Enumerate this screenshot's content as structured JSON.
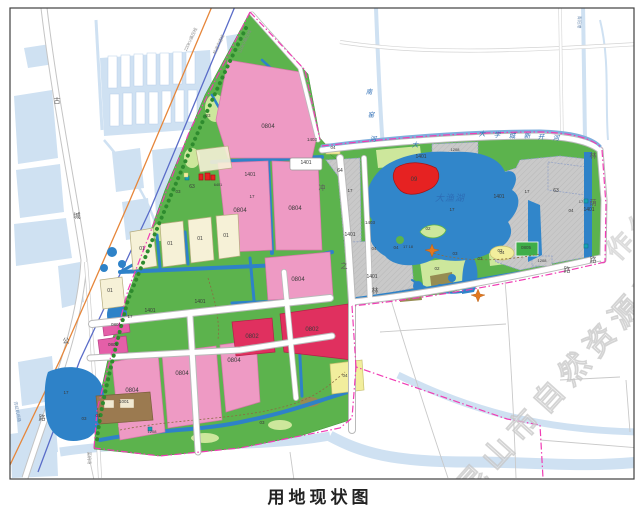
{
  "caption": "用地现状图",
  "watermark": {
    "main": "昆山市自然资源和规划局",
    "partial": "作公"
  },
  "palette": {
    "site_green": "#5cb34d",
    "light_green": "#cde79c",
    "site_water": "#2e82c8",
    "lake_blue": "#3186ca",
    "context_water": "#cfe1f2",
    "pink": "#ee9ac4",
    "crimson": "#e0305f",
    "magenta": "#e45fa8",
    "red": "#e62222",
    "cream": "#f6f1d7",
    "yellow": "#f2ee9d",
    "olive": "#968c52",
    "brown": "#9b7a50",
    "gray_hatch": "#c9c9c9",
    "boundary": "#f03cb4",
    "orange_line": "#e6863a",
    "blue_line": "#5a6cc8",
    "teal_box": "#17a0b4"
  },
  "map": {
    "lake_name": "大渔湖",
    "rivers": [
      "南窑河",
      "大学城新开河"
    ],
    "roads": [
      "古城公路",
      "林荫路"
    ],
    "labels": [
      {
        "t": "0804",
        "x": 268,
        "y": 128
      },
      {
        "t": "0804",
        "x": 240,
        "y": 212
      },
      {
        "t": "0804",
        "x": 295,
        "y": 210
      },
      {
        "t": "0804",
        "x": 298,
        "y": 281
      },
      {
        "t": "0804",
        "x": 132,
        "y": 392
      },
      {
        "t": "0804",
        "x": 182,
        "y": 375
      },
      {
        "t": "0804",
        "x": 234,
        "y": 362
      },
      {
        "t": "0802",
        "x": 252,
        "y": 338
      },
      {
        "t": "0802",
        "x": 312,
        "y": 331
      },
      {
        "t": "0801",
        "x": 116,
        "y": 326,
        "c": "code45"
      },
      {
        "t": "0801",
        "x": 113,
        "y": 346,
        "c": "code45"
      },
      {
        "t": "1001",
        "x": 124,
        "y": 403,
        "c": "code45"
      },
      {
        "t": "01",
        "x": 98,
        "y": 417,
        "c": "code45"
      },
      {
        "t": "01",
        "x": 142,
        "y": 250,
        "c": "code5"
      },
      {
        "t": "01",
        "x": 170,
        "y": 245,
        "c": "code5"
      },
      {
        "t": "01",
        "x": 200,
        "y": 240,
        "c": "code5"
      },
      {
        "t": "01",
        "x": 226,
        "y": 237,
        "c": "code5"
      },
      {
        "t": "01",
        "x": 110,
        "y": 292,
        "c": "code5"
      },
      {
        "t": "1401",
        "x": 250,
        "y": 176,
        "c": "code5"
      },
      {
        "t": "1401",
        "x": 306,
        "y": 164,
        "c": "code5"
      },
      {
        "t": "1401",
        "x": 150,
        "y": 312,
        "c": "code5"
      },
      {
        "t": "1401",
        "x": 200,
        "y": 303,
        "c": "code5"
      },
      {
        "t": "1401",
        "x": 421,
        "y": 158,
        "c": "code5"
      },
      {
        "t": "1401",
        "x": 350,
        "y": 236,
        "c": "code5"
      },
      {
        "t": "1401",
        "x": 372,
        "y": 278,
        "c": "code5"
      },
      {
        "t": "1401",
        "x": 499,
        "y": 198,
        "c": "code5"
      },
      {
        "t": "1401",
        "x": 589,
        "y": 211,
        "c": "code5"
      },
      {
        "t": "1403",
        "x": 312,
        "y": 141,
        "c": "code45"
      },
      {
        "t": "1403",
        "x": 370,
        "y": 224,
        "c": "code45"
      },
      {
        "t": "1208",
        "x": 455,
        "y": 151,
        "c": "code4"
      },
      {
        "t": "1208",
        "x": 542,
        "y": 262,
        "c": "code4"
      },
      {
        "t": "1208",
        "x": 152,
        "y": 433,
        "c": "code4"
      },
      {
        "t": "0805",
        "x": 526,
        "y": 249,
        "c": "code45"
      },
      {
        "t": "09",
        "x": 414,
        "y": 181
      },
      {
        "t": "02",
        "x": 428,
        "y": 230,
        "c": "code45"
      },
      {
        "t": "02",
        "x": 437,
        "y": 270,
        "c": "code45"
      },
      {
        "t": "03",
        "x": 208,
        "y": 117,
        "c": "code45"
      },
      {
        "t": "03",
        "x": 178,
        "y": 193,
        "c": "code45"
      },
      {
        "t": "03",
        "x": 84,
        "y": 420,
        "c": "code45"
      },
      {
        "t": "03",
        "x": 262,
        "y": 424,
        "c": "code45"
      },
      {
        "t": "03",
        "x": 455,
        "y": 255,
        "c": "code45"
      },
      {
        "t": "03",
        "x": 480,
        "y": 260,
        "c": "code45"
      },
      {
        "t": "03",
        "x": 500,
        "y": 252,
        "c": "code45"
      },
      {
        "t": "04",
        "x": 333,
        "y": 149,
        "c": "code45"
      },
      {
        "t": "04",
        "x": 345,
        "y": 377,
        "c": "code45"
      },
      {
        "t": "04",
        "x": 374,
        "y": 250,
        "c": "code45"
      },
      {
        "t": "04",
        "x": 396,
        "y": 249,
        "c": "code45"
      },
      {
        "t": "04",
        "x": 502,
        "y": 254,
        "c": "code45"
      },
      {
        "t": "04",
        "x": 571,
        "y": 212,
        "c": "code45"
      },
      {
        "t": "63",
        "x": 192,
        "y": 188,
        "c": "code5"
      },
      {
        "t": "63",
        "x": 556,
        "y": 192,
        "c": "code5"
      },
      {
        "t": "64",
        "x": 340,
        "y": 172,
        "c": "code5"
      },
      {
        "t": "17",
        "x": 350,
        "y": 192,
        "c": "code45"
      },
      {
        "t": "17",
        "x": 527,
        "y": 193,
        "c": "code45"
      },
      {
        "t": "17",
        "x": 452,
        "y": 211,
        "c": "code45"
      },
      {
        "t": "17",
        "x": 252,
        "y": 198,
        "c": "code45"
      },
      {
        "t": "17",
        "x": 66,
        "y": 394,
        "c": "code45"
      },
      {
        "t": "17",
        "x": 130,
        "y": 318,
        "c": "code45"
      },
      {
        "t": "17",
        "x": 581,
        "y": 203,
        "c": "code4"
      },
      {
        "t": "17 18",
        "x": 408,
        "y": 248,
        "c": "code4"
      },
      {
        "t": "6401",
        "x": 218,
        "y": 186,
        "c": "code38"
      },
      {
        "t": "古",
        "x": 57,
        "y": 103,
        "c": "road"
      },
      {
        "t": "城",
        "x": 77,
        "y": 218,
        "c": "road"
      },
      {
        "t": "公",
        "x": 66,
        "y": 343,
        "c": "road"
      },
      {
        "t": "路",
        "x": 42,
        "y": 420,
        "c": "road"
      },
      {
        "t": "林",
        "x": 593,
        "y": 158,
        "c": "road"
      },
      {
        "t": "荫",
        "x": 593,
        "y": 205,
        "c": "road"
      },
      {
        "t": "路",
        "x": 593,
        "y": 262,
        "c": "road"
      },
      {
        "t": "之",
        "x": 344,
        "y": 268,
        "c": "road"
      },
      {
        "t": "林",
        "x": 375,
        "y": 293,
        "c": "road"
      },
      {
        "t": "路",
        "x": 567,
        "y": 272,
        "c": "road",
        "fs": 6
      },
      {
        "t": "冲",
        "x": 322,
        "y": 190,
        "c": "road",
        "fs": 6
      },
      {
        "t": "大渔湖",
        "x": 450,
        "y": 201,
        "c": "waterbig"
      },
      {
        "t": "南",
        "x": 369,
        "y": 94,
        "c": "water",
        "fs": 7.5
      },
      {
        "t": "窑",
        "x": 371,
        "y": 117,
        "c": "water",
        "fs": 7.5
      },
      {
        "t": "河",
        "x": 373,
        "y": 141,
        "c": "water",
        "fs": 7.5
      },
      {
        "t": "大",
        "x": 415,
        "y": 147,
        "c": "water"
      },
      {
        "t": "大",
        "x": 482,
        "y": 136,
        "c": "water"
      },
      {
        "t": "学",
        "x": 497,
        "y": 137,
        "c": "water"
      },
      {
        "t": "城",
        "x": 512,
        "y": 138,
        "c": "water"
      },
      {
        "t": "新",
        "x": 527,
        "y": 138,
        "c": "water"
      },
      {
        "t": "开",
        "x": 541,
        "y": 139,
        "c": "water"
      },
      {
        "t": "河",
        "x": 556,
        "y": 140,
        "c": "water"
      },
      {
        "t": "220KV高压线",
        "x": 192,
        "y": 40,
        "c": "micro",
        "r": -65
      },
      {
        "t": "轨道交通线",
        "x": 220,
        "y": 45,
        "c": "micro",
        "r": -65
      },
      {
        "t": "110KV高压线",
        "x": 246,
        "y": 42,
        "c": "micro",
        "r": -65
      },
      {
        "t": "青阳港",
        "x": 578,
        "y": 22,
        "c": "microb",
        "r": 90
      },
      {
        "t": "至机场",
        "x": 88,
        "y": 458,
        "c": "micro",
        "r": 90
      },
      {
        "t": "苏虹机场路",
        "x": 16,
        "y": 412,
        "c": "microb",
        "r": 78
      }
    ]
  }
}
